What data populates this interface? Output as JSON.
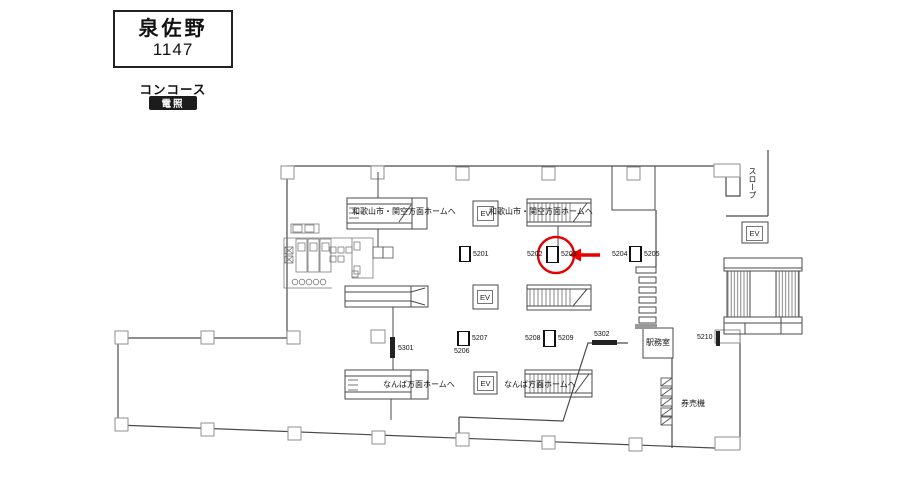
{
  "header": {
    "station_name": "泉佐野",
    "station_code": "1147",
    "area_label": "コンコース",
    "sign_type_badge": "電照"
  },
  "colors": {
    "highlight": "#e60000",
    "badge_bg": "#1c1c1c",
    "wall_line": "#4a4a4a"
  },
  "floorplan": {
    "ev_label": "EV",
    "routes": {
      "wakayama_kanku_left": "和歌山市・関空方面ホームへ",
      "wakayama_kanku_center": "和歌山市・関空方面ホームへ",
      "namba_left": "なんば方面ホームへ",
      "namba_center": "なんば方面ホームへ"
    },
    "rooms": {
      "slope": "スロープ",
      "station_office": "駅務室",
      "ticket_machines": "券売機"
    },
    "signs": {
      "s5201": "5201",
      "s5202": "5202",
      "s5203": "5203",
      "s5204": "5204",
      "s5205": "5205",
      "s5206": "5206",
      "s5207": "5207",
      "s5208": "5208",
      "s5209": "5209",
      "s5210": "5210",
      "s5301": "5301",
      "s5302": "5302"
    }
  }
}
